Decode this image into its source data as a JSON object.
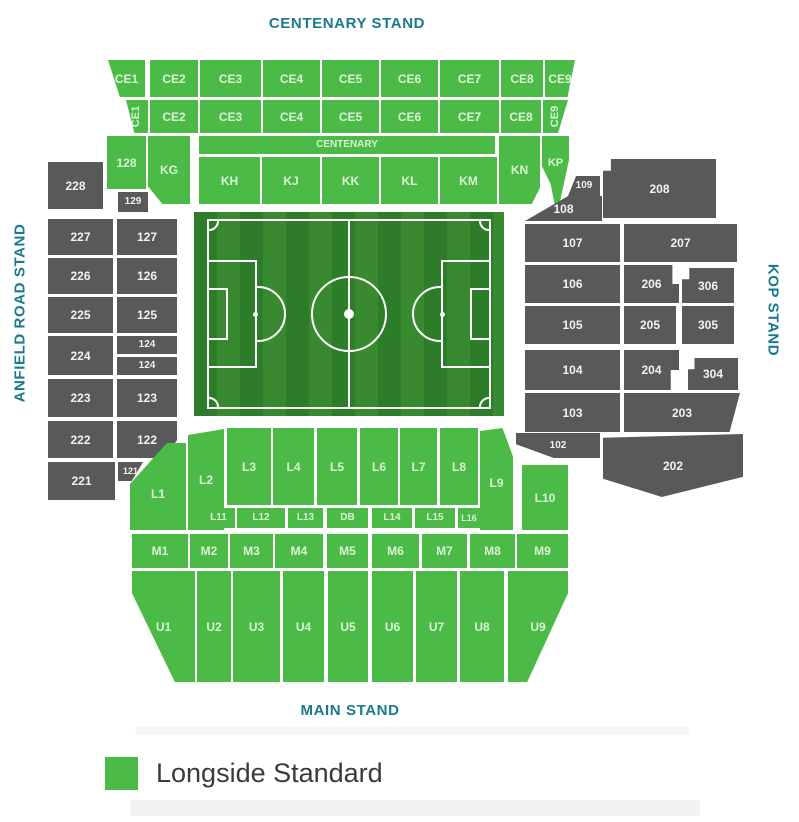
{
  "stands": {
    "top": "CENTENARY STAND",
    "bottom": "MAIN STAND",
    "left": "ANFIELD ROAD STAND",
    "right": "KOP STAND"
  },
  "legend": [
    {
      "label": "Longside Standard",
      "color": "#4cba47"
    }
  ],
  "colors": {
    "available": "#4cba47",
    "unavailable": "#595959",
    "stand_label": "#1a7a8c"
  },
  "map": {
    "sections": [
      {
        "id": "ce1-upper",
        "label": "CE1",
        "x": 108,
        "y": 60,
        "w": 37,
        "h": 37,
        "s": "g",
        "clip": "polygon(0 0,100% 0,100% 100%,32% 100%)"
      },
      {
        "id": "ce2-upper",
        "label": "CE2",
        "x": 150,
        "y": 60,
        "w": 48,
        "h": 37,
        "s": "g"
      },
      {
        "id": "ce3-upper",
        "label": "CE3",
        "x": 200,
        "y": 60,
        "w": 61,
        "h": 37,
        "s": "g"
      },
      {
        "id": "ce4-upper",
        "label": "CE4",
        "x": 263,
        "y": 60,
        "w": 57,
        "h": 37,
        "s": "g"
      },
      {
        "id": "ce5-upper",
        "label": "CE5",
        "x": 322,
        "y": 60,
        "w": 57,
        "h": 37,
        "s": "g"
      },
      {
        "id": "ce6-upper",
        "label": "CE6",
        "x": 381,
        "y": 60,
        "w": 57,
        "h": 37,
        "s": "g"
      },
      {
        "id": "ce7-upper",
        "label": "CE7",
        "x": 440,
        "y": 60,
        "w": 59,
        "h": 37,
        "s": "g"
      },
      {
        "id": "ce8-upper",
        "label": "CE8",
        "x": 501,
        "y": 60,
        "w": 42,
        "h": 37,
        "s": "g"
      },
      {
        "id": "ce9-upper",
        "label": "CE9",
        "x": 545,
        "y": 60,
        "w": 30,
        "h": 37,
        "s": "g",
        "clip": "polygon(0 0,100% 0,75% 100%,0 100%)"
      },
      {
        "id": "ce1-lower",
        "label": "CE1",
        "x": 126,
        "y": 100,
        "w": 22,
        "h": 33,
        "s": "g",
        "clip": "polygon(0 0,100% 0,100% 100%,38% 100%)",
        "fs": 11,
        "rot": true
      },
      {
        "id": "ce2-lower",
        "label": "CE2",
        "x": 150,
        "y": 100,
        "w": 48,
        "h": 33,
        "s": "g"
      },
      {
        "id": "ce3-lower",
        "label": "CE3",
        "x": 200,
        "y": 100,
        "w": 61,
        "h": 33,
        "s": "g"
      },
      {
        "id": "ce4-lower",
        "label": "CE4",
        "x": 263,
        "y": 100,
        "w": 57,
        "h": 33,
        "s": "g"
      },
      {
        "id": "ce5-lower",
        "label": "CE5",
        "x": 322,
        "y": 100,
        "w": 57,
        "h": 33,
        "s": "g"
      },
      {
        "id": "ce6-lower",
        "label": "CE6",
        "x": 381,
        "y": 100,
        "w": 57,
        "h": 33,
        "s": "g"
      },
      {
        "id": "ce7-lower",
        "label": "CE7",
        "x": 440,
        "y": 100,
        "w": 59,
        "h": 33,
        "s": "g"
      },
      {
        "id": "ce8-lower",
        "label": "CE8",
        "x": 501,
        "y": 100,
        "w": 40,
        "h": 33,
        "s": "g"
      },
      {
        "id": "ce9-lower",
        "label": "CE9",
        "x": 543,
        "y": 100,
        "w": 25,
        "h": 33,
        "s": "g",
        "clip": "polygon(0 0,100% 0,60% 100%,0 100%)",
        "fs": 11,
        "rot": true
      },
      {
        "id": "128",
        "label": "128",
        "x": 107,
        "y": 136,
        "w": 39,
        "h": 53,
        "s": "g"
      },
      {
        "id": "kg",
        "label": "KG",
        "x": 148,
        "y": 136,
        "w": 42,
        "h": 68,
        "s": "g",
        "clip": "polygon(0 0,100% 0,100% 100%,34% 100%,0 74%)"
      },
      {
        "id": "centenary-strip",
        "label": "CENTENARY",
        "x": 199,
        "y": 136,
        "w": 296,
        "h": 18,
        "s": "g",
        "fs": 10
      },
      {
        "id": "kh",
        "label": "KH",
        "x": 199,
        "y": 157,
        "w": 61,
        "h": 47,
        "s": "g"
      },
      {
        "id": "kj",
        "label": "KJ",
        "x": 262,
        "y": 157,
        "w": 58,
        "h": 47,
        "s": "g"
      },
      {
        "id": "kk",
        "label": "KK",
        "x": 322,
        "y": 157,
        "w": 57,
        "h": 47,
        "s": "g"
      },
      {
        "id": "kl",
        "label": "KL",
        "x": 381,
        "y": 157,
        "w": 57,
        "h": 47,
        "s": "g"
      },
      {
        "id": "km",
        "label": "KM",
        "x": 440,
        "y": 157,
        "w": 57,
        "h": 47,
        "s": "g"
      },
      {
        "id": "kn",
        "label": "KN",
        "x": 499,
        "y": 136,
        "w": 41,
        "h": 68,
        "s": "g",
        "clip": "polygon(0 0,100% 0,100% 76%,80% 100%,0 100%)"
      },
      {
        "id": "kp",
        "label": "KP",
        "x": 542,
        "y": 136,
        "w": 27,
        "h": 80,
        "s": "g",
        "clip": "polygon(0 0,100% 0,100% 30%,55% 100%,32% 60%,0 38%)",
        "fs": 11,
        "dy": -26
      },
      {
        "id": "228",
        "label": "228",
        "x": 48,
        "y": 162,
        "w": 55,
        "h": 47,
        "s": "d"
      },
      {
        "id": "129",
        "label": "129",
        "x": 118,
        "y": 192,
        "w": 30,
        "h": 20,
        "s": "d",
        "fs": 10
      },
      {
        "id": "227",
        "label": "227",
        "x": 48,
        "y": 219,
        "w": 65,
        "h": 36,
        "s": "d"
      },
      {
        "id": "127",
        "label": "127",
        "x": 117,
        "y": 219,
        "w": 60,
        "h": 36,
        "s": "d"
      },
      {
        "id": "226",
        "label": "226",
        "x": 48,
        "y": 258,
        "w": 65,
        "h": 36,
        "s": "d"
      },
      {
        "id": "126",
        "label": "126",
        "x": 117,
        "y": 258,
        "w": 60,
        "h": 36,
        "s": "d"
      },
      {
        "id": "225",
        "label": "225",
        "x": 48,
        "y": 297,
        "w": 65,
        "h": 36,
        "s": "d"
      },
      {
        "id": "125",
        "label": "125",
        "x": 117,
        "y": 297,
        "w": 60,
        "h": 36,
        "s": "d"
      },
      {
        "id": "224",
        "label": "224",
        "x": 48,
        "y": 336,
        "w": 65,
        "h": 39,
        "s": "d"
      },
      {
        "id": "124-upper",
        "label": "124",
        "x": 117,
        "y": 336,
        "w": 60,
        "h": 18,
        "s": "d",
        "fs": 10
      },
      {
        "id": "124-lower",
        "label": "124",
        "x": 117,
        "y": 357,
        "w": 60,
        "h": 18,
        "s": "d",
        "fs": 10
      },
      {
        "id": "223",
        "label": "223",
        "x": 48,
        "y": 379,
        "w": 65,
        "h": 38,
        "s": "d"
      },
      {
        "id": "123",
        "label": "123",
        "x": 117,
        "y": 379,
        "w": 60,
        "h": 38,
        "s": "d"
      },
      {
        "id": "222",
        "label": "222",
        "x": 48,
        "y": 421,
        "w": 65,
        "h": 37,
        "s": "d"
      },
      {
        "id": "122",
        "label": "122",
        "x": 117,
        "y": 421,
        "w": 60,
        "h": 37,
        "s": "d",
        "clip": "polygon(0 0,100% 0,100% 52%,78% 100%,0 100%)"
      },
      {
        "id": "221",
        "label": "221",
        "x": 48,
        "y": 462,
        "w": 67,
        "h": 38,
        "s": "d"
      },
      {
        "id": "121",
        "label": "121",
        "x": 118,
        "y": 462,
        "w": 25,
        "h": 19,
        "s": "d",
        "fs": 9,
        "clip": "polygon(0 0,100% 0,55% 100%,0 100%)"
      },
      {
        "id": "109",
        "label": "109",
        "x": 568,
        "y": 176,
        "w": 32,
        "h": 20,
        "s": "d",
        "fs": 10,
        "clip": "polygon(25% 0,100% 0,100% 100%,0 100%)"
      },
      {
        "id": "208",
        "label": "208",
        "x": 603,
        "y": 159,
        "w": 113,
        "h": 59,
        "s": "d",
        "clip": "polygon(0 20%,7% 20%,7% 0,100% 0,100% 100%,0 100%)"
      },
      {
        "id": "108",
        "label": "108",
        "x": 525,
        "y": 196,
        "w": 77,
        "h": 25,
        "s": "d",
        "clip": "polygon(56% 0,100% 0,100% 100%,0 100%)"
      },
      {
        "id": "107",
        "label": "107",
        "x": 525,
        "y": 224,
        "w": 95,
        "h": 38,
        "s": "d"
      },
      {
        "id": "207",
        "label": "207",
        "x": 624,
        "y": 224,
        "w": 113,
        "h": 38,
        "s": "d"
      },
      {
        "id": "106",
        "label": "106",
        "x": 525,
        "y": 265,
        "w": 95,
        "h": 38,
        "s": "d"
      },
      {
        "id": "206",
        "label": "206",
        "x": 624,
        "y": 265,
        "w": 55,
        "h": 38,
        "s": "d",
        "clip": "polygon(0 0,88% 0,88% 50%,100% 50%,100% 100%,0 100%)"
      },
      {
        "id": "306",
        "label": "306",
        "x": 682,
        "y": 268,
        "w": 52,
        "h": 35,
        "s": "d",
        "clip": "polygon(0 32%,14% 32%,14% 0,100% 0,100% 100%,0 100%)"
      },
      {
        "id": "105",
        "label": "105",
        "x": 525,
        "y": 306,
        "w": 95,
        "h": 38,
        "s": "d"
      },
      {
        "id": "205",
        "label": "205",
        "x": 624,
        "y": 306,
        "w": 52,
        "h": 38,
        "s": "d"
      },
      {
        "id": "305",
        "label": "305",
        "x": 682,
        "y": 306,
        "w": 52,
        "h": 38,
        "s": "d"
      },
      {
        "id": "104",
        "label": "104",
        "x": 525,
        "y": 350,
        "w": 95,
        "h": 40,
        "s": "d"
      },
      {
        "id": "204",
        "label": "204",
        "x": 624,
        "y": 350,
        "w": 55,
        "h": 40,
        "s": "d",
        "clip": "polygon(0 0,100% 0,100% 50%,85% 50%,85% 100%,0 100%)"
      },
      {
        "id": "304",
        "label": "304",
        "x": 688,
        "y": 358,
        "w": 50,
        "h": 32,
        "s": "d",
        "clip": "polygon(0 35%,13% 35%,13% 0,100% 0,100% 100%,0 100%)"
      },
      {
        "id": "103",
        "label": "103",
        "x": 525,
        "y": 393,
        "w": 95,
        "h": 39,
        "s": "d"
      },
      {
        "id": "203",
        "label": "203",
        "x": 624,
        "y": 393,
        "w": 116,
        "h": 39,
        "s": "d",
        "clip": "polygon(0 0,100% 0,91% 100%,0 100%)"
      },
      {
        "id": "102",
        "label": "102",
        "x": 516,
        "y": 433,
        "w": 84,
        "h": 25,
        "s": "d",
        "fs": 10,
        "clip": "polygon(0 0,100% 0,100% 100%,45% 100%,0 45%)"
      },
      {
        "id": "202",
        "label": "202",
        "x": 603,
        "y": 434,
        "w": 140,
        "h": 63,
        "s": "d",
        "clip": "polygon(0 6%,100% 0,100% 68%,42% 100%,0 71%)"
      },
      {
        "id": "l1",
        "label": "L1",
        "x": 130,
        "y": 443,
        "w": 56,
        "h": 87,
        "s": "g",
        "clip": "polygon(0 47%,66% 0,100% 0,100% 100%,0 100%)",
        "dy": 14
      },
      {
        "id": "l2",
        "label": "L2",
        "x": 188,
        "y": 429,
        "w": 36,
        "h": 101,
        "s": "g",
        "clip": "polygon(0 6%,100% 0,100% 100%,0 100%)"
      },
      {
        "id": "l3",
        "label": "L3",
        "x": 227,
        "y": 428,
        "w": 44,
        "h": 77,
        "s": "g"
      },
      {
        "id": "l4",
        "label": "L4",
        "x": 273,
        "y": 428,
        "w": 41,
        "h": 77,
        "s": "g"
      },
      {
        "id": "l5",
        "label": "L5",
        "x": 317,
        "y": 428,
        "w": 40,
        "h": 77,
        "s": "g"
      },
      {
        "id": "l6",
        "label": "L6",
        "x": 360,
        "y": 428,
        "w": 38,
        "h": 77,
        "s": "g"
      },
      {
        "id": "l7",
        "label": "L7",
        "x": 400,
        "y": 428,
        "w": 37,
        "h": 77,
        "s": "g"
      },
      {
        "id": "l8",
        "label": "L8",
        "x": 440,
        "y": 428,
        "w": 38,
        "h": 77,
        "s": "g"
      },
      {
        "id": "l9",
        "label": "L9",
        "x": 480,
        "y": 428,
        "w": 33,
        "h": 102,
        "s": "g",
        "clip": "polygon(0 3%,68% 0,100% 28%,100% 100%,0 100%)",
        "dy": 8
      },
      {
        "id": "l10",
        "label": "L10",
        "x": 522,
        "y": 465,
        "w": 46,
        "h": 65,
        "s": "g"
      },
      {
        "id": "l11",
        "label": "L11",
        "x": 202,
        "y": 508,
        "w": 33,
        "h": 20,
        "s": "g",
        "fs": 10
      },
      {
        "id": "l12",
        "label": "L12",
        "x": 237,
        "y": 508,
        "w": 48,
        "h": 20,
        "s": "g",
        "fs": 10
      },
      {
        "id": "l13",
        "label": "L13",
        "x": 288,
        "y": 508,
        "w": 35,
        "h": 20,
        "s": "g",
        "fs": 10
      },
      {
        "id": "db",
        "label": "DB",
        "x": 327,
        "y": 508,
        "w": 41,
        "h": 20,
        "s": "g",
        "fs": 10
      },
      {
        "id": "l14",
        "label": "L14",
        "x": 372,
        "y": 508,
        "w": 40,
        "h": 20,
        "s": "g",
        "fs": 10
      },
      {
        "id": "l15",
        "label": "L15",
        "x": 415,
        "y": 508,
        "w": 40,
        "h": 20,
        "s": "g",
        "fs": 10
      },
      {
        "id": "l16",
        "label": "L16",
        "x": 458,
        "y": 508,
        "w": 22,
        "h": 20,
        "s": "g",
        "fs": 9
      },
      {
        "id": "m1",
        "label": "M1",
        "x": 132,
        "y": 534,
        "w": 56,
        "h": 34,
        "s": "g"
      },
      {
        "id": "m2",
        "label": "M2",
        "x": 190,
        "y": 534,
        "w": 38,
        "h": 34,
        "s": "g"
      },
      {
        "id": "m3",
        "label": "M3",
        "x": 230,
        "y": 534,
        "w": 43,
        "h": 34,
        "s": "g"
      },
      {
        "id": "m4",
        "label": "M4",
        "x": 275,
        "y": 534,
        "w": 48,
        "h": 34,
        "s": "g"
      },
      {
        "id": "m5",
        "label": "M5",
        "x": 327,
        "y": 534,
        "w": 41,
        "h": 34,
        "s": "g"
      },
      {
        "id": "m6",
        "label": "M6",
        "x": 372,
        "y": 534,
        "w": 47,
        "h": 34,
        "s": "g"
      },
      {
        "id": "m7",
        "label": "M7",
        "x": 422,
        "y": 534,
        "w": 45,
        "h": 34,
        "s": "g"
      },
      {
        "id": "m8",
        "label": "M8",
        "x": 470,
        "y": 534,
        "w": 45,
        "h": 34,
        "s": "g"
      },
      {
        "id": "m9",
        "label": "M9",
        "x": 517,
        "y": 534,
        "w": 51,
        "h": 34,
        "s": "g"
      },
      {
        "id": "u1",
        "label": "U1",
        "x": 132,
        "y": 571,
        "w": 63,
        "h": 111,
        "s": "g",
        "clip": "polygon(0 0,100% 0,100% 100%,68% 100%,0 20%)"
      },
      {
        "id": "u2",
        "label": "U2",
        "x": 197,
        "y": 571,
        "w": 34,
        "h": 111,
        "s": "g"
      },
      {
        "id": "u3",
        "label": "U3",
        "x": 233,
        "y": 571,
        "w": 47,
        "h": 111,
        "s": "g"
      },
      {
        "id": "u4",
        "label": "U4",
        "x": 283,
        "y": 571,
        "w": 41,
        "h": 111,
        "s": "g"
      },
      {
        "id": "u5",
        "label": "U5",
        "x": 328,
        "y": 571,
        "w": 40,
        "h": 111,
        "s": "g"
      },
      {
        "id": "u6",
        "label": "U6",
        "x": 372,
        "y": 571,
        "w": 41,
        "h": 111,
        "s": "g"
      },
      {
        "id": "u7",
        "label": "U7",
        "x": 416,
        "y": 571,
        "w": 41,
        "h": 111,
        "s": "g"
      },
      {
        "id": "u8",
        "label": "U8",
        "x": 460,
        "y": 571,
        "w": 44,
        "h": 111,
        "s": "g"
      },
      {
        "id": "u9",
        "label": "U9",
        "x": 508,
        "y": 571,
        "w": 60,
        "h": 111,
        "s": "g",
        "clip": "polygon(0 0,100% 0,100% 20%,32% 100%,0 100%)"
      }
    ]
  }
}
